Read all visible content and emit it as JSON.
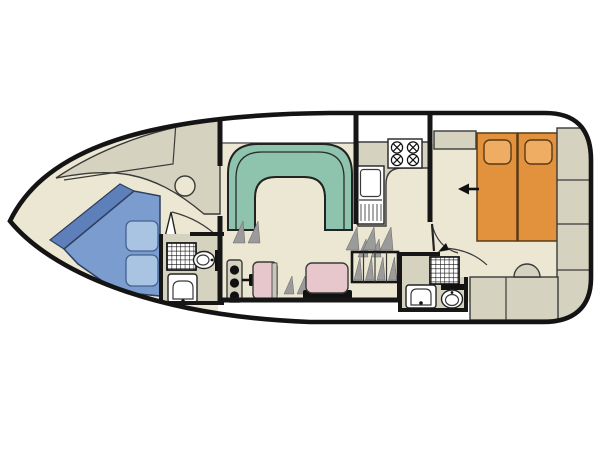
{
  "plan": {
    "title": "Motor cruiser deck plan",
    "orientation": "bow-left-stern-right",
    "visible_text": "none"
  },
  "palette": {
    "paper": "#ffffff",
    "hull_line": "#141414",
    "floor": "#ece7d3",
    "deck_white": "#ffffff",
    "cabinet": "#d6d2c0",
    "wall": "#161616",
    "stroke": "#3a3a3a",
    "sofa": "#8ec4ae",
    "bed_blue": "#7b9ccf",
    "bed_blue_dark": "#5d80ba",
    "pillow_blue": "#a9c3e3",
    "bed_orange": "#e2913d",
    "pillow_orange": "#eead63",
    "seat_pink": "#e8c7cc",
    "fixture": "#ffffff",
    "hatch": "#9b9b9b",
    "black": "#111111"
  },
  "items": {
    "hull": "Boat hull outline",
    "bow_cabin": "Bow cabin",
    "bow_bed": "V-berth double bed with two pillows",
    "bow_cabinet": "Bow cabin worktop and lockers",
    "bow_stool": "Bow cabin seat",
    "forward_bathroom": "Forward bathroom with shower, toilet and washbasin",
    "saloon": "Saloon",
    "settee": "U-shaped settee",
    "helm_console": "Helm console with three controls and throttle",
    "helm_seat_single": "Single helm seat",
    "helm_seat_double": "Double helm seat",
    "galley": "Galley",
    "hob": "Four-burner hob",
    "galley_sink": "Galley sink with drainer",
    "steps": "Companionway steps",
    "aft_bathroom": "Aft bathroom with shower, toilet and washbasin",
    "aft_cabin": "Aft cabin",
    "aft_beds": "Aft double berth (two mattresses with pillows)",
    "entry_arrow": "Direction arrow into aft cabin",
    "wardrobe": "Wardrobe and side lockers",
    "stern_bench": "Stern bench seating",
    "stern_stool": "Round seat at stern bench"
  }
}
